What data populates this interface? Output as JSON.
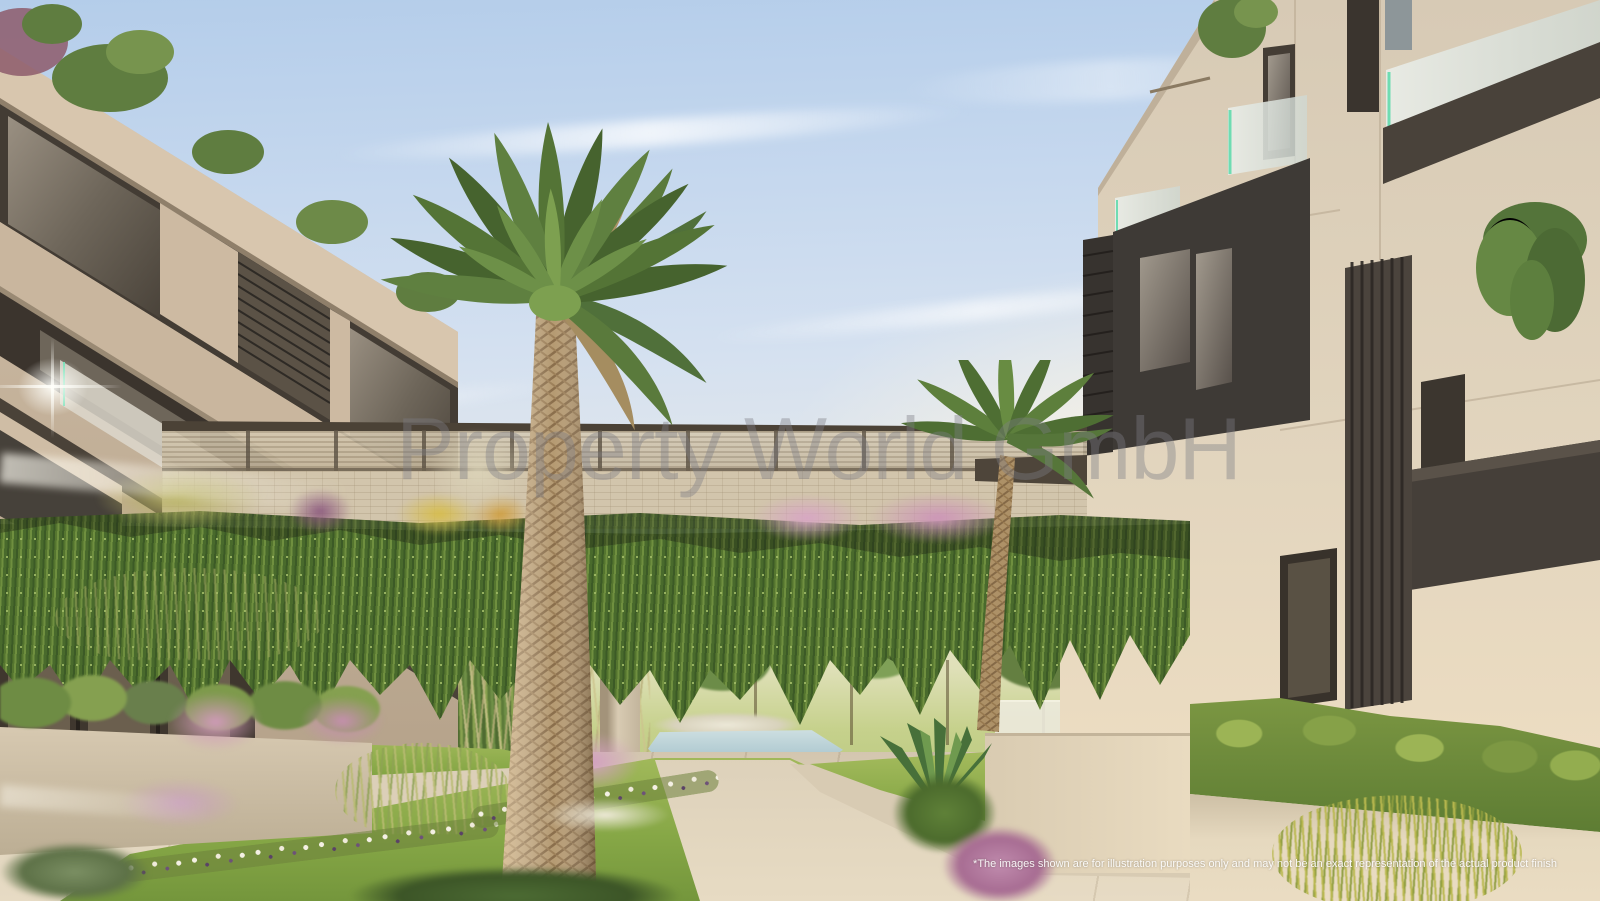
{
  "scene": {
    "type": "architectural-render",
    "subject": "Modern apartment complex courtyard with central palm tree, landscaped gardens, and a vine-covered bridge connecting two residential buildings",
    "watermark": "Property World GmbH",
    "disclaimer": "*The images shown are for illustration purposes only and may not be an exact representation of the actual product finish",
    "palette": {
      "sky_top": "#b4cdea",
      "sky_horizon": "#f4edda",
      "facade_left_beige": "#c9b69e",
      "facade_right_stone": "#ddd0bb",
      "anthracite_panels": "#3f3a35",
      "vine_green": "#55752f",
      "lawn_green": "#86a746",
      "path_beige": "#ddd1ba",
      "water_blue": "#aac6ce",
      "palm_frond_green": "#54742f",
      "palm_trunk_tan": "#b59a72",
      "flower_pink": "#d7a6c3",
      "glass_accent_green": "#6fdcb2"
    }
  }
}
